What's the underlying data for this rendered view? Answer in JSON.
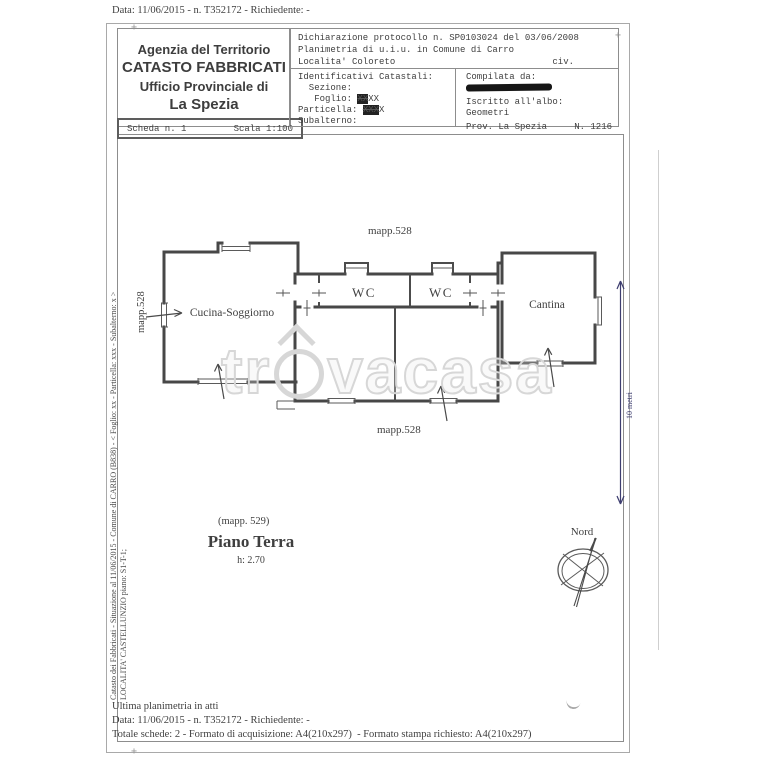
{
  "page": {
    "top_line": "Data: 11/06/2015 - n. T352172 - Richiedente: -",
    "header": {
      "office": {
        "line1": "Agenzia del Territorio",
        "line2": "CATASTO FABBRICATI",
        "line3": "Ufficio Provinciale di",
        "line4": "La Spezia"
      },
      "scheda": {
        "left": "Scheda n. 1",
        "right": "Scala 1:100"
      },
      "declaration": {
        "line1": "Dichiarazione protocollo n. SP0103024 del 03/06/2008",
        "line2": "Planimetria di u.i.u. in Comune di Carro",
        "line3_left": "Localita' Coloreto",
        "line3_right": "civ."
      },
      "identifiers": {
        "title": "Identificativi Catastali:",
        "sezione": "  Sezione:",
        "foglio_label": "   Foglio: ",
        "foglio_scribbled": "XX",
        "foglio_plain": "XX",
        "particella_label": "Particella: ",
        "particella_scribbled": "XXX",
        "particella_plain": "X",
        "subalterno": "Subalterno:"
      },
      "compiler": {
        "label": "Compilata da:",
        "iscritto": "Iscritto all'albo:",
        "albo": "Geometri",
        "prov": "Prov. La Spezia",
        "number": "N. 1216"
      }
    },
    "plan": {
      "mapp_top": "mapp.528",
      "mapp_bottom": "mapp.528",
      "mapp_left": "mapp.528",
      "rooms": {
        "kitchen": "Cucina-Soggiorno",
        "wc1": "WC",
        "wc2": "WC",
        "cantina": "Cantina"
      },
      "floor": {
        "mapp": "(mapp. 529)",
        "title": "Piano Terra",
        "height": "h: 2.70"
      },
      "compass_label": "Nord",
      "scale_label": "10 metri",
      "scale_color": "#3d3d6f"
    },
    "side_text": {
      "line1": "Catasto dei Fabbricati - Situazione al 11/06/2015 - Comune di CARRO (B838) - < Foglio: xx - Particella: xxx - Subalterno: x >",
      "line2": "LOCALITA' CASTELLUNZIO piano: S1-T-1;"
    },
    "watermark": {
      "part1": "tr",
      "part2": "vacasa"
    },
    "footer": {
      "line1": "Ultima planimetria in atti",
      "line2": "Data: 11/06/2015 - n. T352172 - Richiedente: -",
      "line3": "Totale schede: 2 - Formato di acquisizione: A4(210x297)  - Formato stampa richiesto: A4(210x297)"
    }
  }
}
